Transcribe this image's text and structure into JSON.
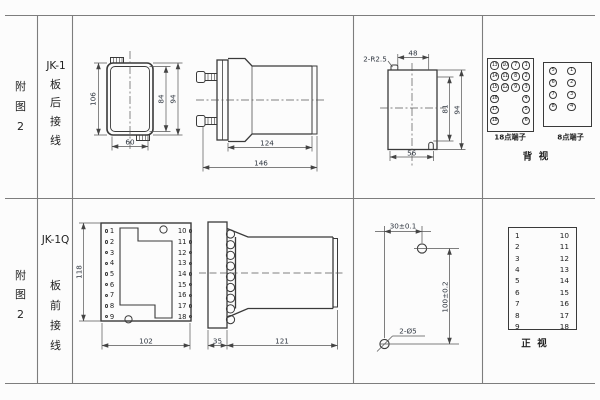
{
  "page": {
    "bg": "#fcfcfc",
    "line_color": "#3a3a3a",
    "dim_color": "#2f3640",
    "grid_color": "#7d7d7d"
  },
  "row1": {
    "fig_label": "附\n图\n2",
    "model": "JK-1",
    "wiring": "板\n后\n接\n线",
    "front": {
      "h_outer": "106",
      "h_inner": "84",
      "h_mid": "94",
      "w": "60"
    },
    "side": {
      "len_body": "124",
      "len_total": "146"
    },
    "cutout": {
      "radius": "2-R2.5",
      "top": "48",
      "inner_h": "81",
      "outer_h": "94",
      "bottom": "56"
    },
    "t18": {
      "label": "18点端子",
      "col1": [
        "13",
        "14",
        "15",
        "16",
        "17",
        "18"
      ],
      "col2": [
        "10",
        "11",
        "12"
      ],
      "col3": [
        "7",
        "8",
        "9"
      ],
      "col4": [
        "1",
        "2",
        "3",
        "4",
        "5",
        "6"
      ]
    },
    "t8": {
      "label": "8点端子",
      "colL": [
        "5",
        "6",
        "7",
        "8"
      ],
      "colR": [
        "1",
        "2",
        "3",
        "4"
      ]
    },
    "view": "背  视"
  },
  "row2": {
    "fig_label": "附\n图\n2",
    "model": "JK-1Q",
    "wiring": "板\n前\n接\n线",
    "front": {
      "left": [
        "1",
        "2",
        "3",
        "4",
        "5",
        "6",
        "7",
        "8",
        "9"
      ],
      "right": [
        "10",
        "11",
        "12",
        "13",
        "14",
        "15",
        "16",
        "17",
        "18"
      ],
      "h": "118",
      "w": "102"
    },
    "side": {
      "flange": "35",
      "body": "121"
    },
    "drill": {
      "pitch_x": "30±0.1",
      "pitch_y": "100±0.2",
      "holes": "2-Ø5"
    },
    "table": {
      "left": [
        "1",
        "2",
        "3",
        "4",
        "5",
        "6",
        "7",
        "8",
        "9"
      ],
      "right": [
        "10",
        "11",
        "12",
        "13",
        "14",
        "15",
        "16",
        "17",
        "18"
      ]
    },
    "view": "正  视"
  }
}
